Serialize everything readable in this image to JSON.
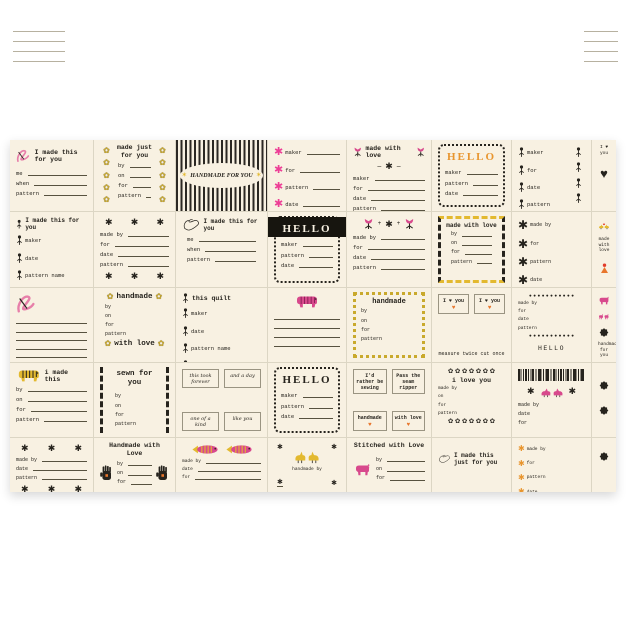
{
  "page": {
    "background": "#ffffff"
  },
  "panel": {
    "background": "#f8f1e2",
    "grid_line_color": "#dcd6c4",
    "accent_colors": {
      "pink": "#d8498c",
      "light_pink": "#e77fa9",
      "gold": "#e3b92f",
      "orange": "#e8952e",
      "rust": "#e8762c",
      "red": "#e23b2a",
      "black": "#26231d"
    },
    "corner_fragments": {
      "left_lines": 4,
      "right_lines": 4
    },
    "cells": [
      {
        "name": "label-i-made-this-for-you-ribbon",
        "blocks": [
          {
            "k": "row",
            "pre": [
              "ribbon-pink"
            ],
            "t": "I made this for you",
            "cls": "tl s65"
          },
          {
            "k": "fields",
            "items": [
              "me",
              "when",
              "pattern"
            ],
            "cls": "s55"
          }
        ]
      },
      {
        "name": "label-made-just-for-you-flowers",
        "cls": "padx",
        "blocks": [
          {
            "k": "sidecol",
            "side": "left",
            "icon": "flower-gold",
            "n": 5
          },
          {
            "k": "sidecol",
            "side": "right",
            "icon": "flower-gold",
            "n": 5
          },
          {
            "k": "title",
            "t": "made just for you",
            "cls": "tw s65 center"
          },
          {
            "k": "fields",
            "items": [
              "by",
              "on",
              "for",
              "pattern"
            ],
            "cls": "s55 inset"
          }
        ]
      },
      {
        "name": "label-handmade-for-you-stripes",
        "cls": "stripes",
        "cellcls": "nopad",
        "blocks": [
          {
            "k": "oval",
            "t": "HANDMADE FOR YOU"
          }
        ]
      },
      {
        "name": "label-pink-asterisk-fields",
        "blocks": [
          {
            "k": "fields",
            "items": [
              "maker",
              "for",
              "pattern",
              "date"
            ],
            "icon": "asterisk-pink",
            "cls": "s55 tall"
          }
        ]
      },
      {
        "name": "label-made-with-love-tulips",
        "blocks": [
          {
            "k": "row",
            "pre": [
              "tulip"
            ],
            "t": "made with love",
            "post": [
              "tulip"
            ],
            "cls": "ctr s65"
          },
          {
            "k": "motif",
            "icons": [
              "dash",
              "asterisk-black",
              "dash"
            ]
          },
          {
            "k": "fields",
            "items": [
              "maker",
              "for",
              "date",
              "pattern"
            ],
            "cls": "s55"
          }
        ]
      },
      {
        "name": "label-hello-dotted-orange",
        "cls": "f-dotted",
        "blocks": [
          {
            "k": "title",
            "t": "HELLO",
            "cls": "hello orange"
          },
          {
            "k": "fields",
            "items": [
              "maker",
              "pattern",
              "date"
            ],
            "cls": "s55"
          }
        ]
      },
      {
        "name": "label-flower-stem-fields",
        "blocks": [
          {
            "k": "sidecol",
            "side": "right",
            "icon": "stem",
            "n": 4
          },
          {
            "k": "fields",
            "items": [
              "maker",
              "for",
              "date",
              "pattern"
            ],
            "icon": "stem",
            "line": false,
            "cls": "s55 tall"
          }
        ]
      },
      {
        "name": "label-i-heart-you",
        "blocks": [
          {
            "k": "caption",
            "t": "I ♥ you",
            "cls": "s45"
          },
          {
            "k": "gap",
            "h": 8
          },
          {
            "k": "motif",
            "icons": [
              "heart-black"
            ]
          }
        ]
      },
      {
        "name": "label-i-made-this-stems",
        "blocks": [
          {
            "k": "row",
            "pre": [
              "stem"
            ],
            "t": "I made this for you",
            "cls": "tl s6"
          },
          {
            "k": "fields",
            "items": [
              "maker",
              "date",
              "pattern name",
              "date"
            ],
            "icon": "stem",
            "line": false,
            "cls": "s55 tall"
          }
        ]
      },
      {
        "name": "label-asterisk-frame",
        "blocks": [
          {
            "k": "motif",
            "icons": [
              "asterisk-black",
              "asterisk-black",
              "asterisk-black"
            ],
            "cls": "spread"
          },
          {
            "k": "fields",
            "items": [
              "made by",
              "for",
              "date",
              "pattern"
            ],
            "cls": "s55"
          },
          {
            "k": "motif",
            "icons": [
              "asterisk-black",
              "asterisk-black",
              "asterisk-black"
            ],
            "cls": "spread"
          }
        ]
      },
      {
        "name": "label-dove-i-made-this",
        "blocks": [
          {
            "k": "row",
            "pre": [
              "dove"
            ],
            "t": "I made this for you",
            "cls": "tl s6"
          },
          {
            "k": "fields",
            "items": [
              "me",
              "when",
              "pattern"
            ],
            "cls": "s55 inset"
          }
        ]
      },
      {
        "name": "label-hello-black-band",
        "cls": "f-dotted",
        "blocks": [
          {
            "k": "band"
          },
          {
            "k": "title",
            "t": "HELLO",
            "cls": "hello white"
          },
          {
            "k": "fields",
            "items": [
              "maker",
              "pattern",
              "date"
            ],
            "cls": "s55"
          }
        ]
      },
      {
        "name": "label-tulip-star-fields",
        "blocks": [
          {
            "k": "motif",
            "icons": [
              "tulip",
              "plus",
              "asterisk-black",
              "plus",
              "tulip"
            ]
          },
          {
            "k": "fields",
            "items": [
              "made by",
              "for",
              "date",
              "pattern"
            ],
            "cls": "s55"
          }
        ]
      },
      {
        "name": "label-rickrack-made-with-love",
        "cls": "rickrack",
        "blocks": [
          {
            "k": "title",
            "t": "made with love",
            "cls": "tw s6 center"
          },
          {
            "k": "fields",
            "items": [
              "by",
              "on",
              "for",
              "pattern"
            ],
            "cls": "s5 inset"
          }
        ]
      },
      {
        "name": "label-black-asterisk-fields",
        "blocks": [
          {
            "k": "fields",
            "items": [
              "made by",
              "for",
              "pattern",
              "date"
            ],
            "icon": "asterisk-black-big",
            "line": false,
            "cls": "s5 tall"
          }
        ]
      },
      {
        "name": "label-birds-made-with-love",
        "blocks": [
          {
            "k": "motif",
            "icons": [
              "birds-heart-yellow"
            ]
          },
          {
            "k": "caption",
            "t": "made with love",
            "cls": "s45"
          },
          {
            "k": "gap",
            "h": 6
          },
          {
            "k": "motif",
            "icons": [
              "figure-orange"
            ]
          }
        ]
      },
      {
        "name": "label-ribbon-blank-lines",
        "blocks": [
          {
            "k": "row",
            "pre": [
              "ribbon-pink"
            ],
            "cls": "tl"
          },
          {
            "k": "lines",
            "n": 5
          }
        ]
      },
      {
        "name": "label-handmade-with-love-flowers",
        "blocks": [
          {
            "k": "row",
            "pre": [
              "flower-gold"
            ],
            "t": "handmade",
            "post": [
              "flower-gold"
            ],
            "cls": "ctr s75"
          },
          {
            "k": "fields",
            "items": [
              "by",
              "on",
              "for",
              "pattern"
            ],
            "line": false,
            "cls": "s5 inset"
          },
          {
            "k": "row",
            "pre": [
              "flower-gold"
            ],
            "t": "with love",
            "post": [
              "flower-gold"
            ],
            "cls": "ctr s75"
          }
        ]
      },
      {
        "name": "label-this-quilt-stems",
        "blocks": [
          {
            "k": "row",
            "pre": [
              "stem"
            ],
            "t": "this quilt",
            "cls": "tl s65"
          },
          {
            "k": "fields",
            "items": [
              "maker",
              "date",
              "pattern name",
              "date"
            ],
            "icon": "stem",
            "line": false,
            "cls": "s55 tall"
          }
        ]
      },
      {
        "name": "label-pink-tiger-lines",
        "blocks": [
          {
            "k": "motif",
            "icons": [
              "tiger-pink"
            ]
          },
          {
            "k": "lines",
            "n": 4
          }
        ]
      },
      {
        "name": "label-handmade-flower-frame",
        "cls": "f-gold",
        "blocks": [
          {
            "k": "title",
            "t": "handmade",
            "cls": "tw s7 center"
          },
          {
            "k": "fields",
            "items": [
              "by",
              "on",
              "for",
              "pattern"
            ],
            "line": false,
            "cls": "s5"
          }
        ]
      },
      {
        "name": "label-i-heart-you-tags",
        "blocks": [
          {
            "k": "tags",
            "rows": [
              [
                "I ♥ you",
                "I ♥ you"
              ]
            ],
            "hearts": [
              true
            ],
            "cls": "twt s5"
          },
          {
            "k": "caption",
            "t": "measure twice cut once",
            "cls": "s5"
          }
        ]
      },
      {
        "name": "label-circles-hello-barcode",
        "blocks": [
          {
            "k": "dotrow",
            "icon": "dot",
            "n": 11
          },
          {
            "k": "fields",
            "items": [
              "made by",
              "for",
              "date",
              "pattern"
            ],
            "line": false,
            "cls": "s45"
          },
          {
            "k": "dotrow",
            "icon": "dot",
            "n": 11
          },
          {
            "k": "barcode"
          },
          {
            "k": "caption",
            "t": "HELLO",
            "cls": "s65 ls"
          },
          {
            "k": "barcode"
          }
        ]
      },
      {
        "name": "label-pink-animals-star",
        "blocks": [
          {
            "k": "motif",
            "icons": [
              "pig-pink"
            ]
          },
          {
            "k": "motif",
            "icons": [
              "rabbits-pink"
            ]
          },
          {
            "k": "motif",
            "icons": [
              "star8"
            ]
          },
          {
            "k": "caption",
            "t": "handmade for you",
            "cls": "s45"
          }
        ]
      },
      {
        "name": "label-yellow-tiger-i-made-this",
        "blocks": [
          {
            "k": "row",
            "pre": [
              "tiger-yellow"
            ],
            "t": "i made this",
            "cls": "tl s65"
          },
          {
            "k": "fields",
            "items": [
              "by",
              "on",
              "for",
              "pattern"
            ],
            "cls": "s55"
          }
        ]
      },
      {
        "name": "label-sewn-for-you-zigzag",
        "cls": "zigzag",
        "blocks": [
          {
            "k": "title",
            "t": "sewn for you",
            "cls": "tw s75 center"
          },
          {
            "k": "gap",
            "h": 3
          },
          {
            "k": "fields",
            "items": [
              "by",
              "on",
              "for",
              "pattern"
            ],
            "line": false,
            "cls": "s5 inset"
          }
        ]
      },
      {
        "name": "label-quote-tags-forever",
        "blocks": [
          {
            "k": "tags",
            "rows": [
              [
                "this took forever",
                "and a day"
              ],
              [
                "one of a kind",
                "like you"
              ]
            ],
            "cls": "script s5"
          }
        ]
      },
      {
        "name": "label-hello-dotted-black",
        "cls": "f-dotted",
        "blocks": [
          {
            "k": "title",
            "t": "HELLO",
            "cls": "hello"
          },
          {
            "k": "fields",
            "items": [
              "maker",
              "pattern",
              "date"
            ],
            "cls": "s55"
          }
        ]
      },
      {
        "name": "label-quote-tags-sewing",
        "blocks": [
          {
            "k": "tags",
            "rows": [
              [
                "I'd rather be sewing",
                "Pass the seam ripper"
              ],
              [
                "handmade",
                "with love"
              ]
            ],
            "hearts": [
              false,
              true
            ],
            "cls": "twt s5"
          }
        ]
      },
      {
        "name": "label-i-love-you-flower-rows",
        "blocks": [
          {
            "k": "dotrow",
            "icon": "flower-black",
            "n": 7
          },
          {
            "k": "title",
            "t": "i love you",
            "cls": "tw s65 center"
          },
          {
            "k": "fields",
            "items": [
              "made by",
              "on",
              "for",
              "pattern"
            ],
            "line": false,
            "cls": "s45"
          },
          {
            "k": "dotrow",
            "icon": "flower-black",
            "n": 7
          }
        ]
      },
      {
        "name": "label-birds-stars-barcode",
        "blocks": [
          {
            "k": "barcode"
          },
          {
            "k": "motif",
            "icons": [
              "asterisk-black",
              "birds-pink",
              "asterisk-black"
            ]
          },
          {
            "k": "fields",
            "items": [
              "made by",
              "date",
              "for"
            ],
            "line": false,
            "cls": "s5"
          }
        ]
      },
      {
        "name": "label-two-black-stars",
        "blocks": [
          {
            "k": "gap",
            "h": 10
          },
          {
            "k": "motif",
            "icons": [
              "star8"
            ]
          },
          {
            "k": "gap",
            "h": 8
          },
          {
            "k": "motif",
            "icons": [
              "star8"
            ]
          }
        ]
      },
      {
        "name": "label-asterisk-frame-2",
        "blocks": [
          {
            "k": "motif",
            "icons": [
              "asterisk-black",
              "asterisk-black",
              "asterisk-black"
            ],
            "cls": "spread"
          },
          {
            "k": "fields",
            "items": [
              "made by",
              "date",
              "pattern"
            ],
            "cls": "s5"
          },
          {
            "k": "motif",
            "icons": [
              "asterisk-black",
              "asterisk-black",
              "asterisk-black"
            ],
            "cls": "spread"
          }
        ]
      },
      {
        "name": "label-handmade-with-love-hands",
        "blocks": [
          {
            "k": "title",
            "t": "Handmade with Love",
            "cls": "tw s65 center"
          },
          {
            "k": "trio",
            "left": "hand-black",
            "right": "hand-black",
            "items": [
              "by",
              "on",
              "for"
            ],
            "cls": "s5"
          }
        ]
      },
      {
        "name": "label-fish-fields",
        "blocks": [
          {
            "k": "motif",
            "icons": [
              "fish",
              "fish"
            ]
          },
          {
            "k": "fields",
            "items": [
              "made by",
              "date",
              "for"
            ],
            "cls": "s45"
          }
        ]
      },
      {
        "name": "label-yellow-birds-handmade-by",
        "blocks": [
          {
            "k": "corners",
            "icon": "asterisk-black"
          },
          {
            "k": "gap",
            "h": 5
          },
          {
            "k": "motif",
            "icons": [
              "birds-yellow"
            ]
          },
          {
            "k": "caption",
            "t": "handmade by",
            "cls": "s45"
          }
        ]
      },
      {
        "name": "label-stitched-with-love",
        "blocks": [
          {
            "k": "title",
            "t": "Stitched with Love",
            "cls": "tw s65 center"
          },
          {
            "k": "trio",
            "left": "pig-pink",
            "items": [
              "by",
              "on",
              "for"
            ],
            "cls": "s5"
          }
        ]
      },
      {
        "name": "label-dove-just-for-you",
        "blocks": [
          {
            "k": "gap",
            "h": 8
          },
          {
            "k": "row",
            "pre": [
              "dove"
            ],
            "t": "I made this just for you",
            "cls": "ctr s6"
          }
        ]
      },
      {
        "name": "label-orange-asterisk-fields",
        "blocks": [
          {
            "k": "fields",
            "items": [
              "made by",
              "for",
              "pattern",
              "date"
            ],
            "icon": "asterisk-orange",
            "line": false,
            "cls": "s45 tall"
          }
        ]
      },
      {
        "name": "label-single-star",
        "blocks": [
          {
            "k": "gap",
            "h": 6
          },
          {
            "k": "motif",
            "icons": [
              "star8"
            ]
          }
        ]
      }
    ]
  }
}
